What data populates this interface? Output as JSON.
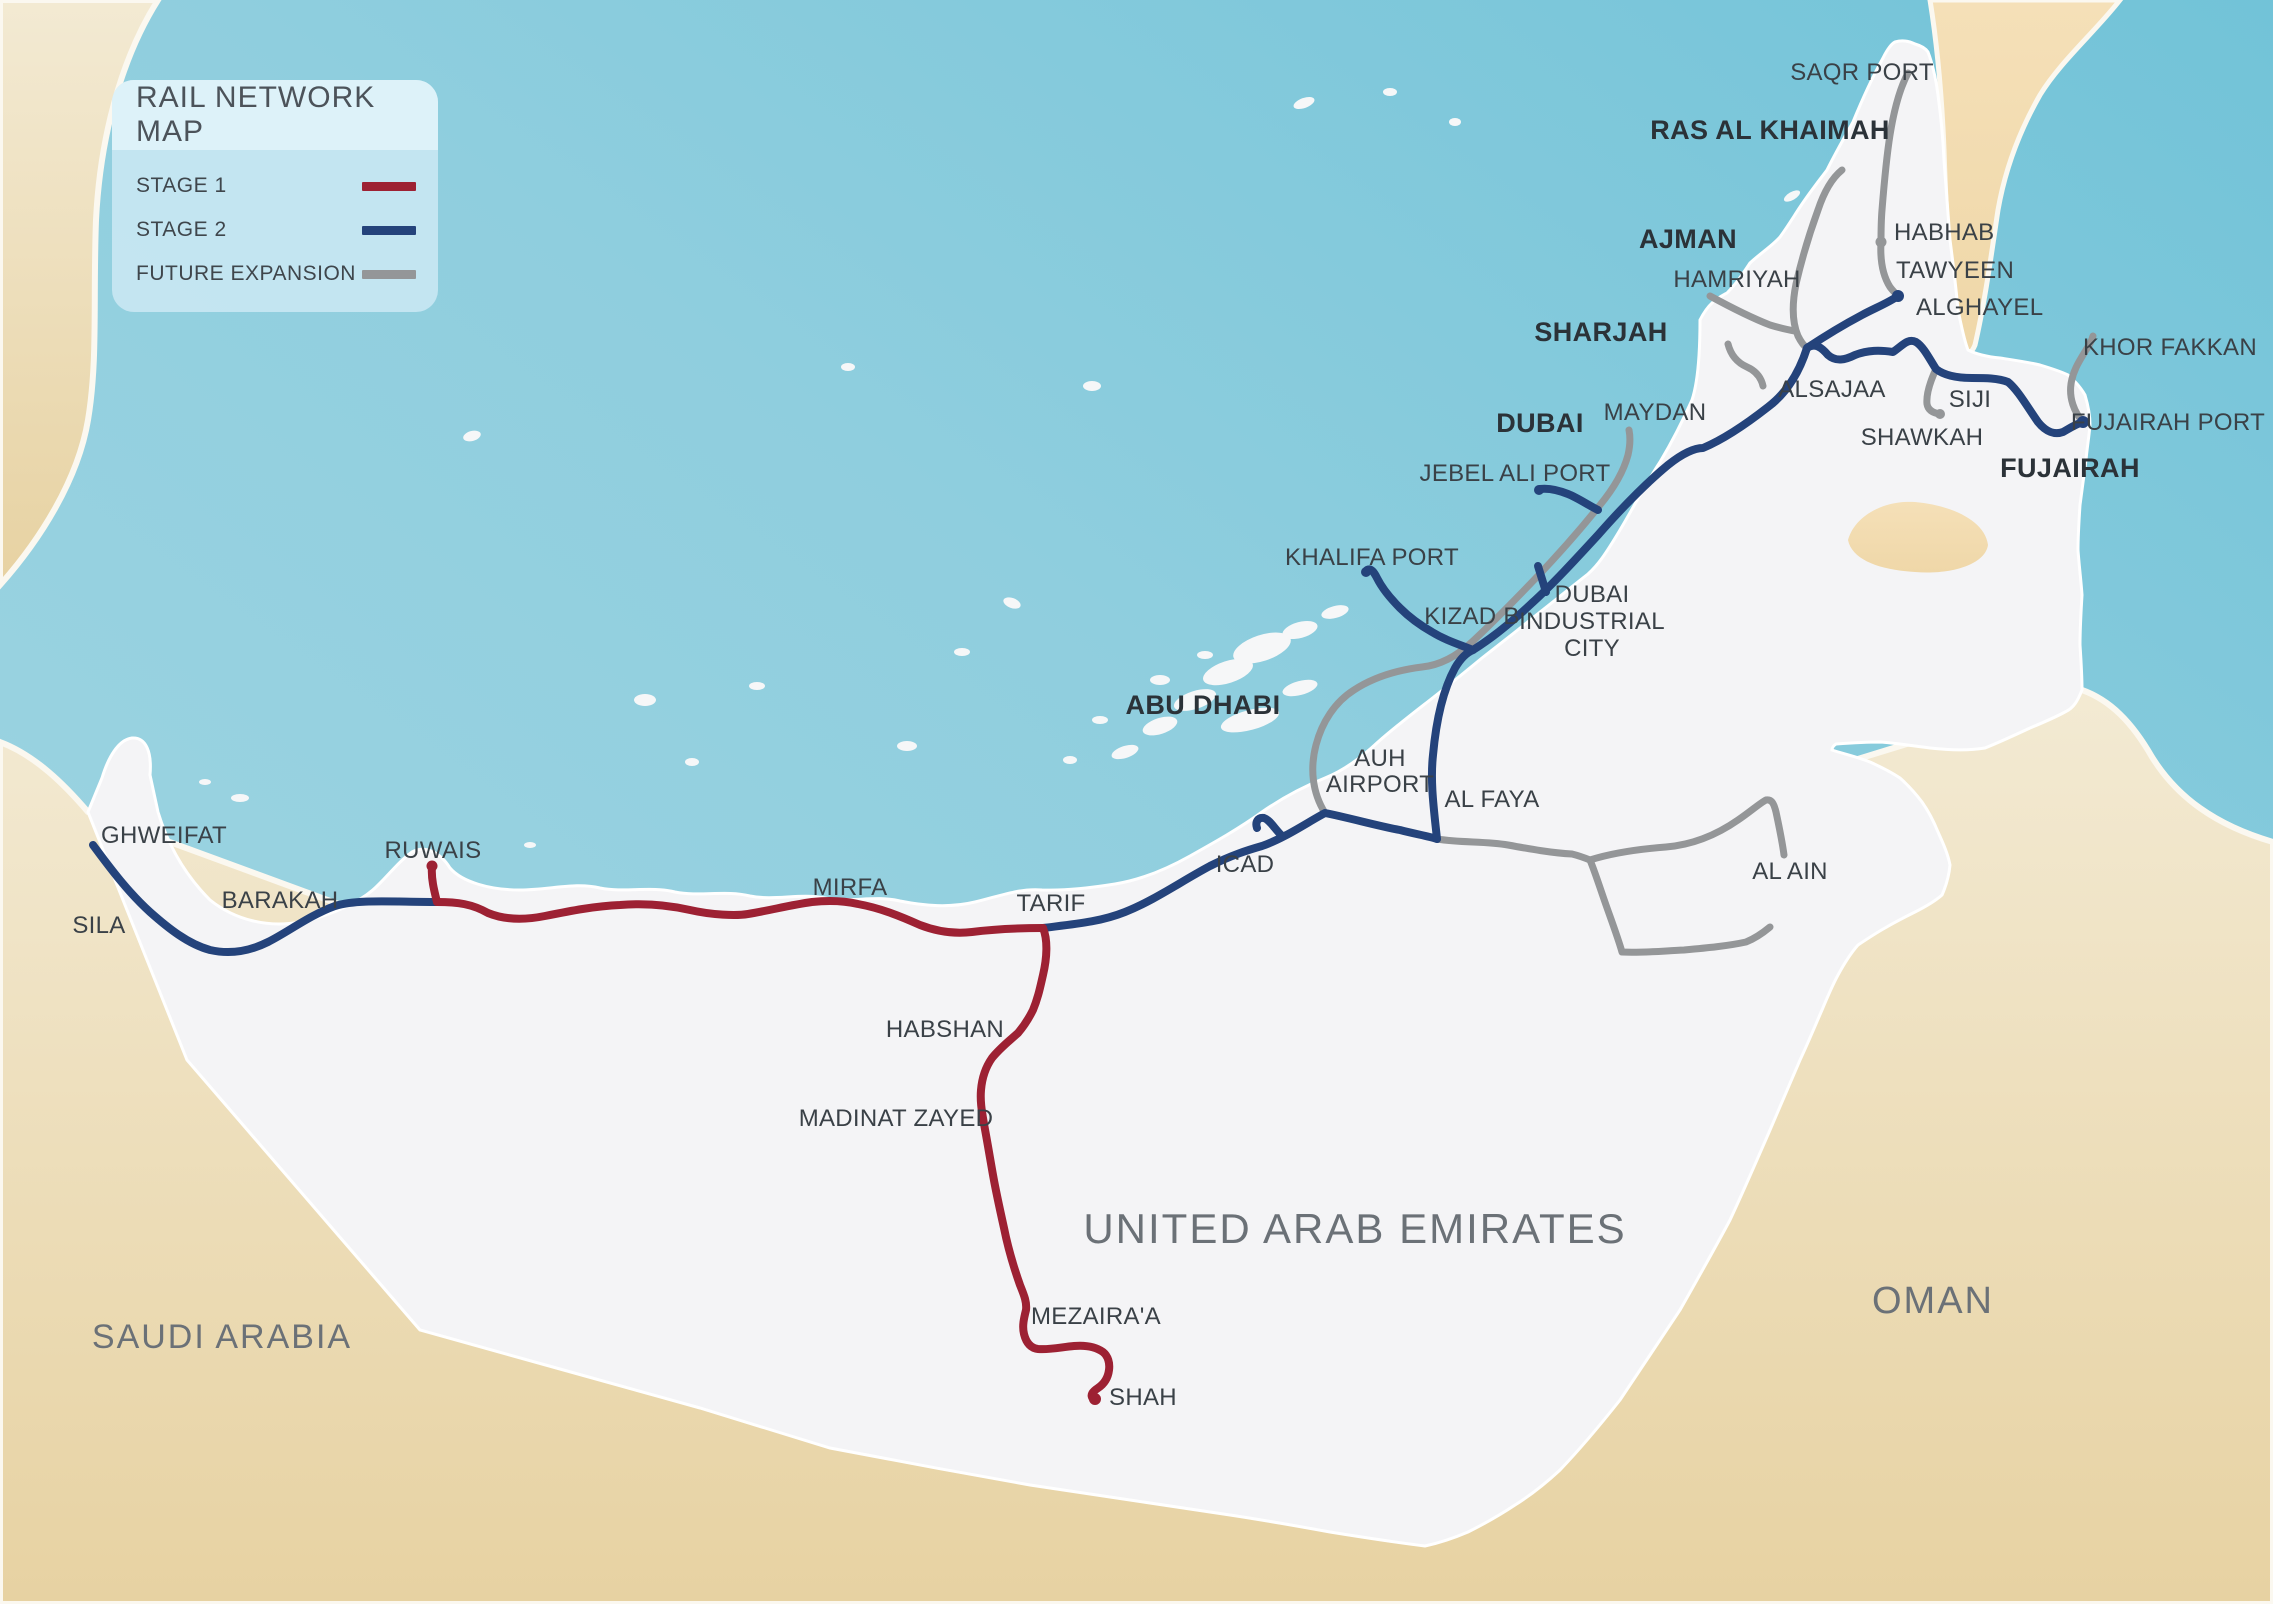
{
  "legend": {
    "title": "RAIL NETWORK MAP",
    "items": [
      {
        "label": "STAGE 1",
        "color": "#9d2133"
      },
      {
        "label": "STAGE 2",
        "color": "#24437b"
      },
      {
        "label": "FUTURE EXPANSION",
        "color": "#949698"
      }
    ]
  },
  "colors": {
    "stage1_red": "#9d2133",
    "stage2_blue": "#24437b",
    "future_gray": "#949698",
    "sea_light": "#a2d6e3",
    "sea_deep": "#76c5da",
    "uae_land": "#f4f4f6",
    "foreign_land": "#f0e6cc",
    "foreign_land_deep": "#e7d2a2",
    "station_text": "#3a4147",
    "country_text": "#6b7177"
  },
  "map": {
    "countries": [
      {
        "name": "united-arab-emirates",
        "label": "UNITED ARAB EMIRATES"
      },
      {
        "name": "saudi-arabia",
        "label": "SAUDI ARABIA"
      },
      {
        "name": "oman",
        "label": "OMAN"
      }
    ],
    "cities": [
      {
        "name": "abu-dhabi",
        "label": "ABU DHABI"
      },
      {
        "name": "dubai",
        "label": "DUBAI"
      },
      {
        "name": "sharjah",
        "label": "SHARJAH"
      },
      {
        "name": "ajman",
        "label": "AJMAN"
      },
      {
        "name": "ras-al-khaimah",
        "label": "RAS AL KHAIMAH"
      },
      {
        "name": "fujairah",
        "label": "FUJAIRAH"
      }
    ],
    "stations": [
      {
        "name": "sila",
        "label": "SILA"
      },
      {
        "name": "ghweifat",
        "label": "GHWEIFAT"
      },
      {
        "name": "barakah",
        "label": "BARAKAH"
      },
      {
        "name": "ruwais",
        "label": "RUWAIS"
      },
      {
        "name": "mirfa",
        "label": "MIRFA"
      },
      {
        "name": "tarif",
        "label": "TARIF"
      },
      {
        "name": "habshan",
        "label": "HABSHAN"
      },
      {
        "name": "madinat-zayed",
        "label": "MADINAT ZAYED"
      },
      {
        "name": "mezairaa",
        "label": "MEZAIRA'A"
      },
      {
        "name": "shah",
        "label": "SHAH"
      },
      {
        "name": "icad",
        "label": "ICAD"
      },
      {
        "name": "auh-airport",
        "label": "AUH AIRPORT",
        "lines": [
          "AUH",
          "AIRPORT"
        ]
      },
      {
        "name": "al-faya",
        "label": "AL FAYA"
      },
      {
        "name": "khalifa-port",
        "label": "KHALIFA PORT"
      },
      {
        "name": "kizad-b",
        "label": "KIZAD B"
      },
      {
        "name": "jebel-ali-port",
        "label": "JEBEL ALI PORT"
      },
      {
        "name": "dubai-industrial-city",
        "label": "DUBAI INDUSTRIAL CITY",
        "lines": [
          "DUBAI",
          "INDUSTRIAL",
          "CITY"
        ]
      },
      {
        "name": "maydan",
        "label": "MAYDAN"
      },
      {
        "name": "hamriyah",
        "label": "HAMRIYAH"
      },
      {
        "name": "alsajaa",
        "label": "ALSAJAA"
      },
      {
        "name": "siji",
        "label": "SIJI"
      },
      {
        "name": "shawkah",
        "label": "SHAWKAH"
      },
      {
        "name": "alghayel",
        "label": "ALGHAYEL"
      },
      {
        "name": "tawyeen",
        "label": "TAWYEEN"
      },
      {
        "name": "habhab",
        "label": "HABHAB"
      },
      {
        "name": "saqr-port",
        "label": "SAQR PORT"
      },
      {
        "name": "khor-fakkan",
        "label": "KHOR FAKKAN"
      },
      {
        "name": "fujairah-port",
        "label": "FUJAIRAH PORT"
      },
      {
        "name": "al-ain",
        "label": "AL AIN"
      }
    ]
  }
}
